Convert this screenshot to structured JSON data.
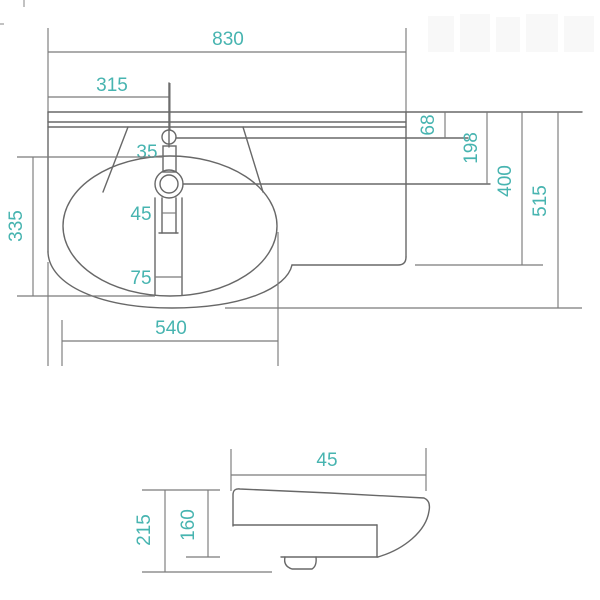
{
  "accent_color": "#47b4b0",
  "line_color": "#686868",
  "drawing_type": "washbasin dimension drawing",
  "top_view": {
    "name": "washbasin top view",
    "dims": {
      "total_width": "830",
      "tap_center_from_left": "315",
      "tap_to_bowl_gap": "35",
      "back_to_tap_hole": "68",
      "back_to_mixer_hole": "198",
      "right_section_depth": "400",
      "total_depth": "515",
      "drain_slot_upper": "45",
      "drain_slot_lower": "75",
      "bowl_depth": "335",
      "bowl_width": "540"
    }
  },
  "side_view": {
    "name": "washbasin side profile view",
    "dims": {
      "rim_depth": "45",
      "total_height": "215",
      "body_height": "160"
    }
  }
}
